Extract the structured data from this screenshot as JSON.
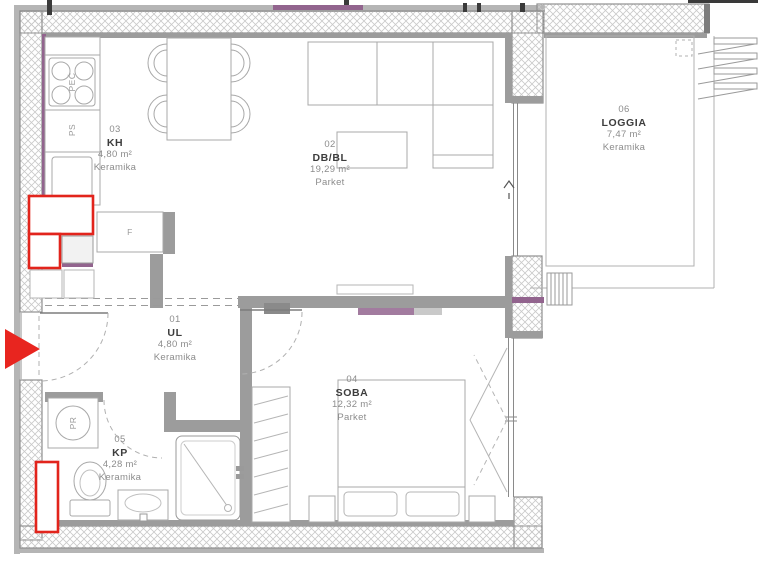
{
  "plan": {
    "title": "apartment-floor-plan",
    "rooms": [
      {
        "id": "01",
        "name": "UL",
        "area": "4,80 m²",
        "floor": "Keramika"
      },
      {
        "id": "02",
        "name": "DB/BL",
        "area": "19,29 m²",
        "floor": "Parket"
      },
      {
        "id": "03",
        "name": "KH",
        "area": "4,80 m²",
        "floor": "Keramika"
      },
      {
        "id": "04",
        "name": "SOBA",
        "area": "12,32 m²",
        "floor": "Parket"
      },
      {
        "id": "05",
        "name": "KP",
        "area": "4,28 m²",
        "floor": "Keramika"
      },
      {
        "id": "06",
        "name": "LOGGIA",
        "area": "7,47 m²",
        "floor": "Keramika"
      }
    ],
    "fixtures": {
      "stove": "PEĆ",
      "dishwasher": "PS",
      "fridge": "F",
      "washer": "PR"
    },
    "colors": {
      "wall_gray": "#9c9c9c",
      "wall_edge": "#8f8f8f",
      "hatch_line": "#c9c9c9",
      "accent_purple": "#92648e",
      "highlight_red": "#e2241c",
      "furniture_line": "#a8a8a8",
      "text_dark": "#3d3d3d",
      "text_gray": "#8c8c8c"
    }
  }
}
